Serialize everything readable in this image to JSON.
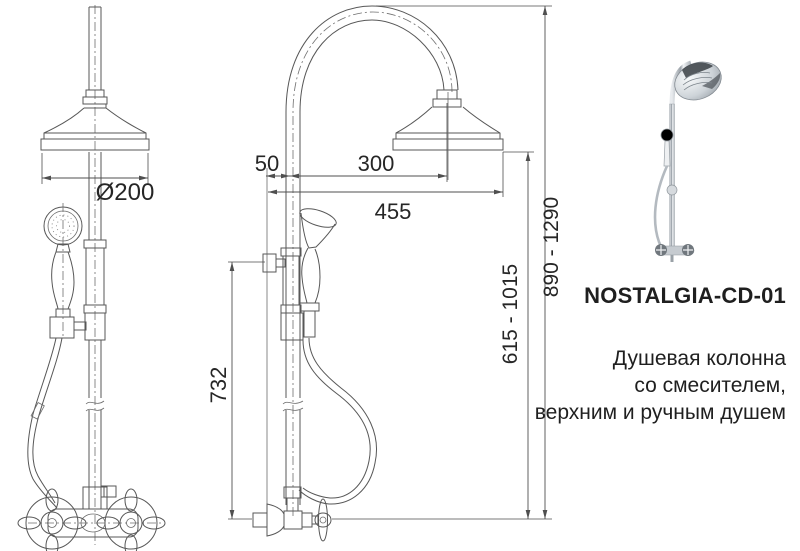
{
  "drawing": {
    "dims": {
      "diameter": "Ø200",
      "offset_wall": "50",
      "offset_head": "300",
      "total_depth": "455",
      "bracket_height": "732",
      "hand_shower_height": "615 - 1015",
      "total_height": "890 - 1290"
    }
  },
  "product": {
    "code": "NOSTALGIA-CD-01",
    "description_lines": [
      "Душевая колонна",
      "со смесителем,",
      "верхним и ручным душем"
    ]
  },
  "colors": {
    "background": "#ffffff",
    "line": "#575757",
    "text": "#1f1f1f"
  }
}
